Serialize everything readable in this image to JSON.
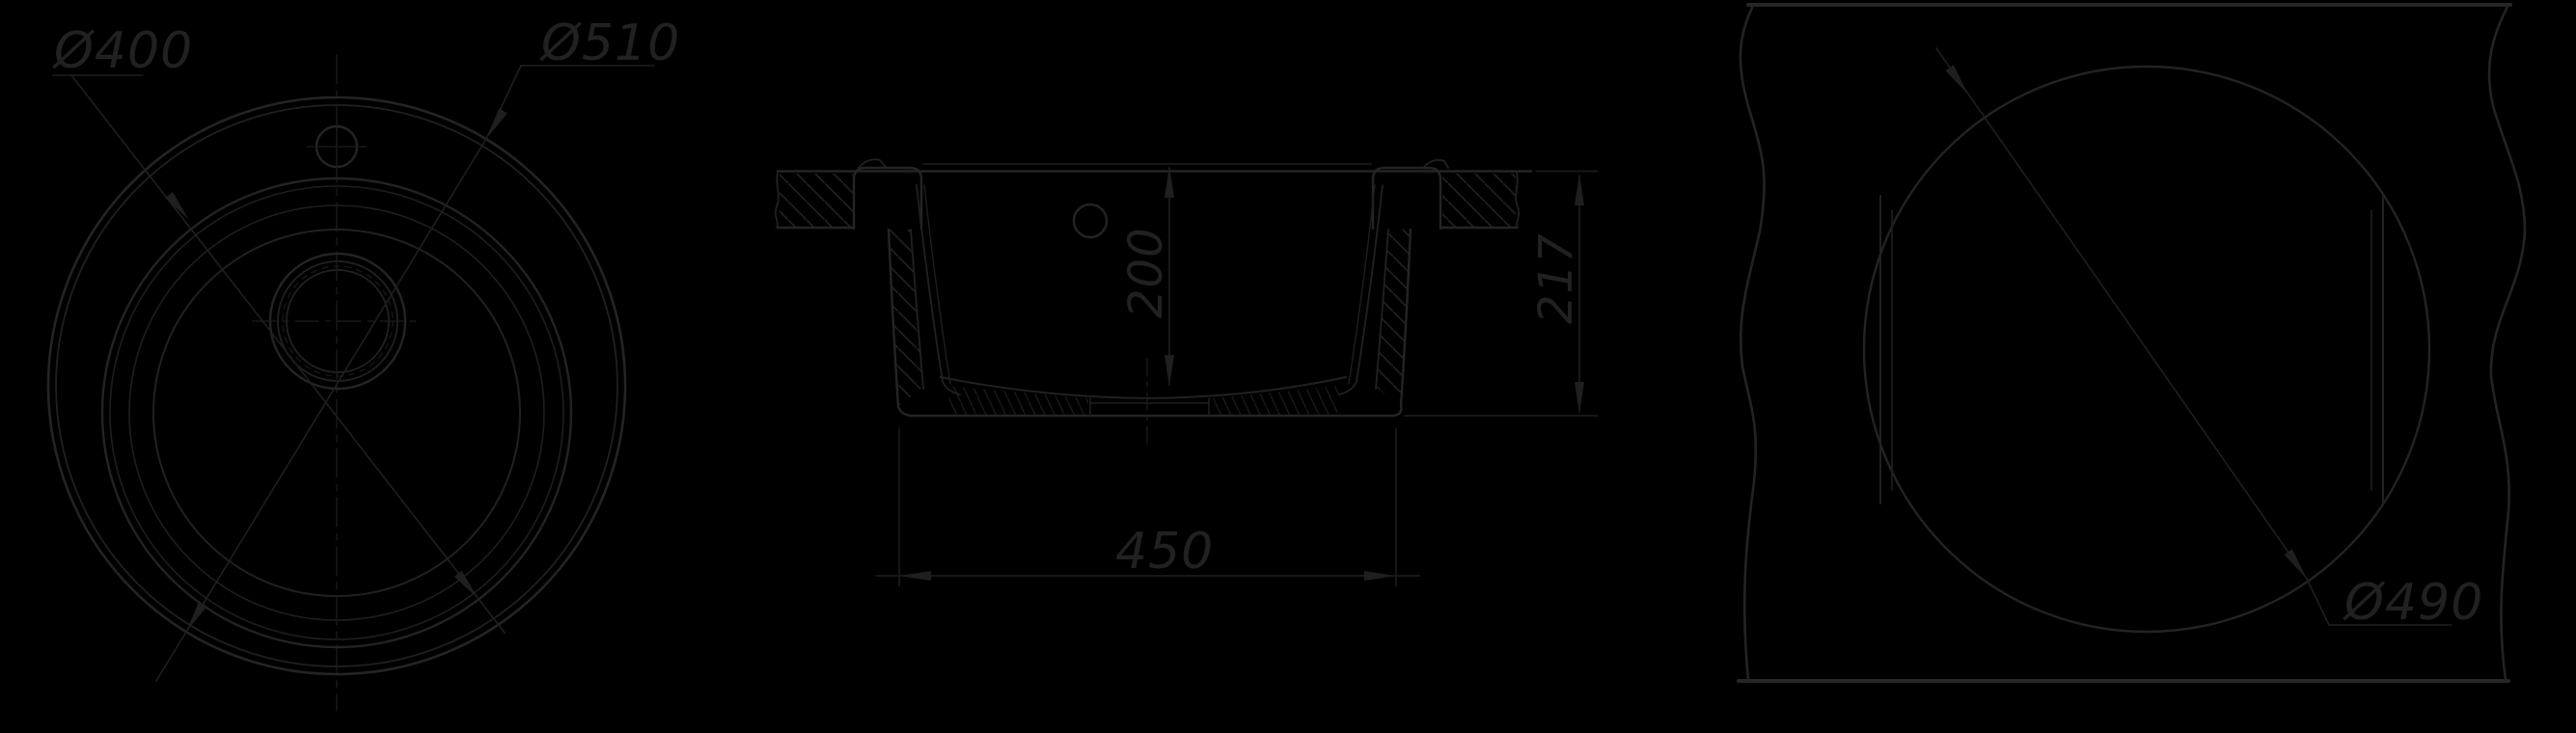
{
  "drawing": {
    "title": "sink-technical-drawing",
    "background": "#000000",
    "ink": "#212121",
    "views": {
      "top_view": {
        "name": "round sink top view",
        "dim_labels": {
          "bowl_diameter": "Ø400",
          "rim_diameter": "Ø510"
        }
      },
      "section_view": {
        "name": "sink cross section",
        "dim_labels": {
          "depth": "200",
          "height": "217",
          "bottom_width": "450"
        }
      },
      "cutout_view": {
        "name": "countertop cutout template",
        "dim_labels": {
          "cutout_diameter": "Ø490"
        }
      }
    }
  }
}
